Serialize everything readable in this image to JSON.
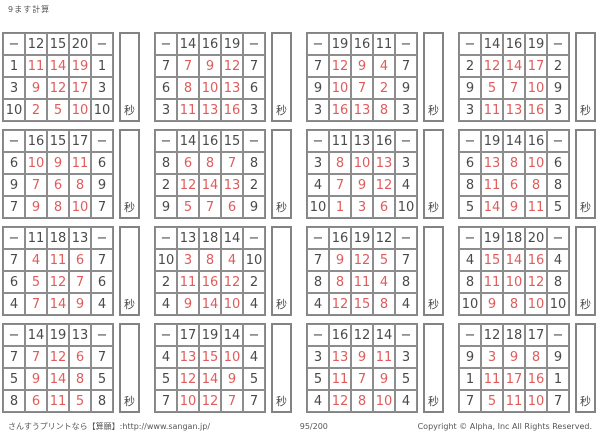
{
  "page": {
    "title": "9ます計算",
    "seconds_label": "秒",
    "footer": {
      "left": "さんすうプリントなら【算願】:http://www.sangan.jp/",
      "center": "95/200",
      "right": "Copyright © Alpha, Inc All Rights Reserved."
    }
  },
  "colors": {
    "grid_border": "#838383",
    "number_dark": "#4a4a4a",
    "answer_red": "#e05c5c"
  },
  "tables": [
    {
      "header": [
        "−",
        "12",
        "15",
        "20",
        "−"
      ],
      "rows": [
        [
          "1",
          "11",
          "14",
          "19",
          "1"
        ],
        [
          "3",
          "9",
          "12",
          "17",
          "3"
        ],
        [
          "10",
          "2",
          "5",
          "10",
          "10"
        ]
      ]
    },
    {
      "header": [
        "−",
        "14",
        "16",
        "19",
        "−"
      ],
      "rows": [
        [
          "7",
          "7",
          "9",
          "12",
          "7"
        ],
        [
          "6",
          "8",
          "10",
          "13",
          "6"
        ],
        [
          "3",
          "11",
          "13",
          "16",
          "3"
        ]
      ]
    },
    {
      "header": [
        "−",
        "19",
        "16",
        "11",
        "−"
      ],
      "rows": [
        [
          "7",
          "12",
          "9",
          "4",
          "7"
        ],
        [
          "9",
          "10",
          "7",
          "2",
          "9"
        ],
        [
          "3",
          "16",
          "13",
          "8",
          "3"
        ]
      ]
    },
    {
      "header": [
        "−",
        "14",
        "16",
        "19",
        "−"
      ],
      "rows": [
        [
          "2",
          "12",
          "14",
          "17",
          "2"
        ],
        [
          "9",
          "5",
          "7",
          "10",
          "9"
        ],
        [
          "3",
          "11",
          "13",
          "16",
          "3"
        ]
      ]
    },
    {
      "header": [
        "−",
        "16",
        "15",
        "17",
        "−"
      ],
      "rows": [
        [
          "6",
          "10",
          "9",
          "11",
          "6"
        ],
        [
          "9",
          "7",
          "6",
          "8",
          "9"
        ],
        [
          "7",
          "9",
          "8",
          "10",
          "7"
        ]
      ]
    },
    {
      "header": [
        "−",
        "14",
        "16",
        "15",
        "−"
      ],
      "rows": [
        [
          "8",
          "6",
          "8",
          "7",
          "8"
        ],
        [
          "2",
          "12",
          "14",
          "13",
          "2"
        ],
        [
          "9",
          "5",
          "7",
          "6",
          "9"
        ]
      ]
    },
    {
      "header": [
        "−",
        "11",
        "13",
        "16",
        "−"
      ],
      "rows": [
        [
          "3",
          "8",
          "10",
          "13",
          "3"
        ],
        [
          "4",
          "7",
          "9",
          "12",
          "4"
        ],
        [
          "10",
          "1",
          "3",
          "6",
          "10"
        ]
      ]
    },
    {
      "header": [
        "−",
        "19",
        "14",
        "16",
        "−"
      ],
      "rows": [
        [
          "6",
          "13",
          "8",
          "10",
          "6"
        ],
        [
          "8",
          "11",
          "6",
          "8",
          "8"
        ],
        [
          "5",
          "14",
          "9",
          "11",
          "5"
        ]
      ]
    },
    {
      "header": [
        "−",
        "11",
        "18",
        "13",
        "−"
      ],
      "rows": [
        [
          "7",
          "4",
          "11",
          "6",
          "7"
        ],
        [
          "6",
          "5",
          "12",
          "7",
          "6"
        ],
        [
          "4",
          "7",
          "14",
          "9",
          "4"
        ]
      ]
    },
    {
      "header": [
        "−",
        "13",
        "18",
        "14",
        "−"
      ],
      "rows": [
        [
          "10",
          "3",
          "8",
          "4",
          "10"
        ],
        [
          "2",
          "11",
          "16",
          "12",
          "2"
        ],
        [
          "4",
          "9",
          "14",
          "10",
          "4"
        ]
      ]
    },
    {
      "header": [
        "−",
        "16",
        "19",
        "12",
        "−"
      ],
      "rows": [
        [
          "7",
          "9",
          "12",
          "5",
          "7"
        ],
        [
          "8",
          "8",
          "11",
          "4",
          "8"
        ],
        [
          "4",
          "12",
          "15",
          "8",
          "4"
        ]
      ]
    },
    {
      "header": [
        "−",
        "19",
        "18",
        "20",
        "−"
      ],
      "rows": [
        [
          "4",
          "15",
          "14",
          "16",
          "4"
        ],
        [
          "8",
          "11",
          "10",
          "12",
          "8"
        ],
        [
          "10",
          "9",
          "8",
          "10",
          "10"
        ]
      ]
    },
    {
      "header": [
        "−",
        "14",
        "19",
        "13",
        "−"
      ],
      "rows": [
        [
          "7",
          "7",
          "12",
          "6",
          "7"
        ],
        [
          "5",
          "9",
          "14",
          "8",
          "5"
        ],
        [
          "8",
          "6",
          "11",
          "5",
          "8"
        ]
      ]
    },
    {
      "header": [
        "−",
        "17",
        "19",
        "14",
        "−"
      ],
      "rows": [
        [
          "4",
          "13",
          "15",
          "10",
          "4"
        ],
        [
          "5",
          "12",
          "14",
          "9",
          "5"
        ],
        [
          "7",
          "10",
          "12",
          "7",
          "7"
        ]
      ]
    },
    {
      "header": [
        "−",
        "16",
        "12",
        "14",
        "−"
      ],
      "rows": [
        [
          "3",
          "13",
          "9",
          "11",
          "3"
        ],
        [
          "5",
          "11",
          "7",
          "9",
          "5"
        ],
        [
          "4",
          "12",
          "8",
          "10",
          "4"
        ]
      ]
    },
    {
      "header": [
        "−",
        "12",
        "18",
        "17",
        "−"
      ],
      "rows": [
        [
          "9",
          "3",
          "9",
          "8",
          "9"
        ],
        [
          "1",
          "11",
          "17",
          "16",
          "1"
        ],
        [
          "7",
          "5",
          "11",
          "10",
          "7"
        ]
      ]
    }
  ]
}
